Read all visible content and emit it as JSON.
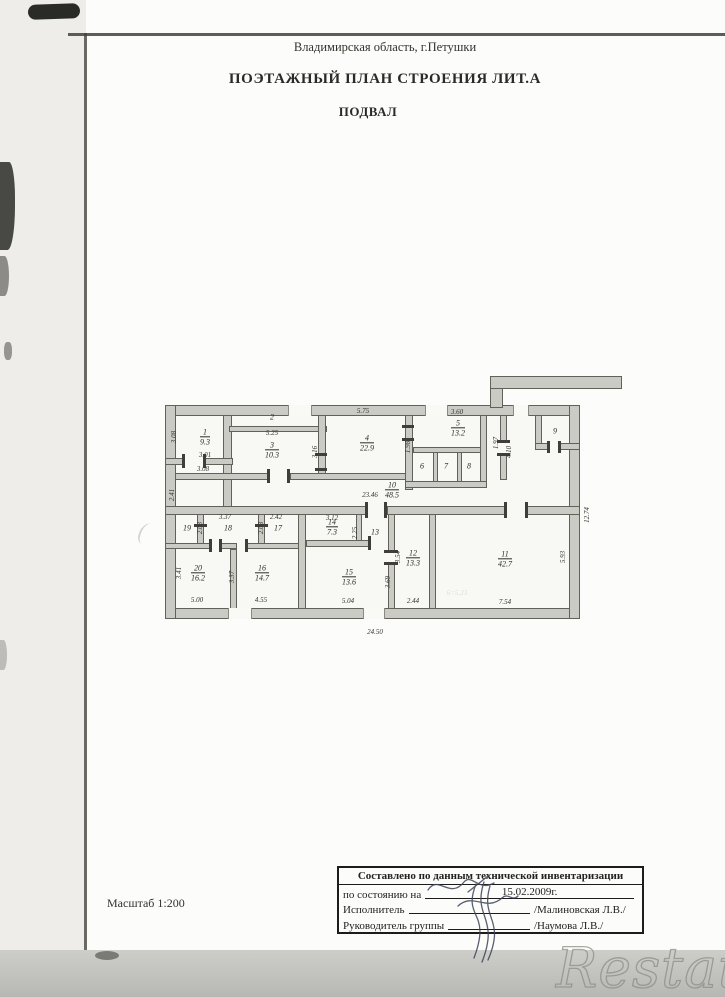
{
  "page": {
    "region_header": "Владимирская область, г.Петушки",
    "title": "ПОЭТАЖНЫЙ ПЛАН СТРОЕНИЯ ЛИТ.А",
    "subtitle": "ПОДВАЛ",
    "scale_label": "Масштаб  1:200",
    "watermark": "Restate"
  },
  "stamp": {
    "title": "Составлено по данным технической инвентаризации",
    "rows": [
      {
        "label": "по состоянию на",
        "value": "15.02.2009г."
      },
      {
        "label": "Исполнитель",
        "value": "/Малиновская Л.В./"
      },
      {
        "label": "Руководитель группы",
        "value": "/Наумова Л.В./"
      }
    ]
  },
  "floor_plan": {
    "bottom_overall_dim": "24.50",
    "rooms": [
      {
        "n": "1",
        "a": "9.3",
        "x": 42,
        "y": 64
      },
      {
        "n": "2",
        "a": "",
        "x": 109,
        "y": 44
      },
      {
        "n": "3",
        "a": "10.3",
        "x": 109,
        "y": 77
      },
      {
        "n": "4",
        "a": "22.9",
        "x": 204,
        "y": 70
      },
      {
        "n": "5",
        "a": "13.2",
        "x": 295,
        "y": 55
      },
      {
        "n": "6",
        "a": "",
        "x": 259,
        "y": 93
      },
      {
        "n": "7",
        "a": "",
        "x": 283,
        "y": 93
      },
      {
        "n": "8",
        "a": "",
        "x": 306,
        "y": 93
      },
      {
        "n": "9",
        "a": "",
        "x": 392,
        "y": 58
      },
      {
        "n": "10",
        "a": "48.5",
        "x": 229,
        "y": 117
      },
      {
        "n": "19",
        "a": "",
        "x": 24,
        "y": 155
      },
      {
        "n": "18",
        "a": "",
        "x": 65,
        "y": 155
      },
      {
        "n": "17",
        "a": "",
        "x": 115,
        "y": 155
      },
      {
        "n": "14",
        "a": "7.3",
        "x": 169,
        "y": 154
      },
      {
        "n": "13",
        "a": "",
        "x": 212,
        "y": 159
      },
      {
        "n": "12",
        "a": "13.3",
        "x": 250,
        "y": 185
      },
      {
        "n": "20",
        "a": "16.2",
        "x": 35,
        "y": 200
      },
      {
        "n": "16",
        "a": "14.7",
        "x": 99,
        "y": 200
      },
      {
        "n": "15",
        "a": "13.6",
        "x": 186,
        "y": 204
      },
      {
        "n": "11",
        "a": "42.7",
        "x": 342,
        "y": 186
      }
    ],
    "dims": [
      {
        "t": "3.08",
        "x": 11,
        "y": 64,
        "v": 1
      },
      {
        "t": "3.01",
        "x": 42,
        "y": 82
      },
      {
        "t": "3.08",
        "x": 40,
        "y": 96
      },
      {
        "t": "2.41",
        "x": 9,
        "y": 122,
        "v": 1
      },
      {
        "t": "5.25",
        "x": 109,
        "y": 60
      },
      {
        "t": "5.75",
        "x": 200,
        "y": 38
      },
      {
        "t": "3.16",
        "x": 152,
        "y": 79,
        "v": 1
      },
      {
        "t": "3.60",
        "x": 294,
        "y": 39
      },
      {
        "t": "1.98",
        "x": 245,
        "y": 74,
        "v": 1
      },
      {
        "t": "1.97",
        "x": 333,
        "y": 70,
        "v": 1
      },
      {
        "t": "4.10",
        "x": 346,
        "y": 79,
        "v": 1
      },
      {
        "t": "23.46",
        "x": 207,
        "y": 122
      },
      {
        "t": "3.37",
        "x": 62,
        "y": 144
      },
      {
        "t": "2.42",
        "x": 113,
        "y": 144
      },
      {
        "t": "2.03",
        "x": 37,
        "y": 155,
        "v": 1
      },
      {
        "t": "2.08",
        "x": 98,
        "y": 155,
        "v": 1
      },
      {
        "t": "3.12",
        "x": 169,
        "y": 145
      },
      {
        "t": "2.25",
        "x": 192,
        "y": 160,
        "v": 1
      },
      {
        "t": "3.54",
        "x": 235,
        "y": 184,
        "v": 1
      },
      {
        "t": "3.41",
        "x": 16,
        "y": 200,
        "v": 1
      },
      {
        "t": "3.37",
        "x": 69,
        "y": 204,
        "v": 1
      },
      {
        "t": "3.69",
        "x": 225,
        "y": 209,
        "v": 1
      },
      {
        "t": "5.00",
        "x": 34,
        "y": 227
      },
      {
        "t": "4.55",
        "x": 98,
        "y": 227
      },
      {
        "t": "5.04",
        "x": 185,
        "y": 228
      },
      {
        "t": "2.44",
        "x": 250,
        "y": 228
      },
      {
        "t": "7.54",
        "x": 342,
        "y": 229
      },
      {
        "t": "5.93",
        "x": 400,
        "y": 184,
        "v": 1
      },
      {
        "t": "12.74",
        "x": 424,
        "y": 142,
        "v": 1
      },
      {
        "t": "24.50",
        "x": 212,
        "y": 259
      },
      {
        "t": "6=5,23",
        "x": 294,
        "y": 220,
        "f": 1
      }
    ]
  }
}
